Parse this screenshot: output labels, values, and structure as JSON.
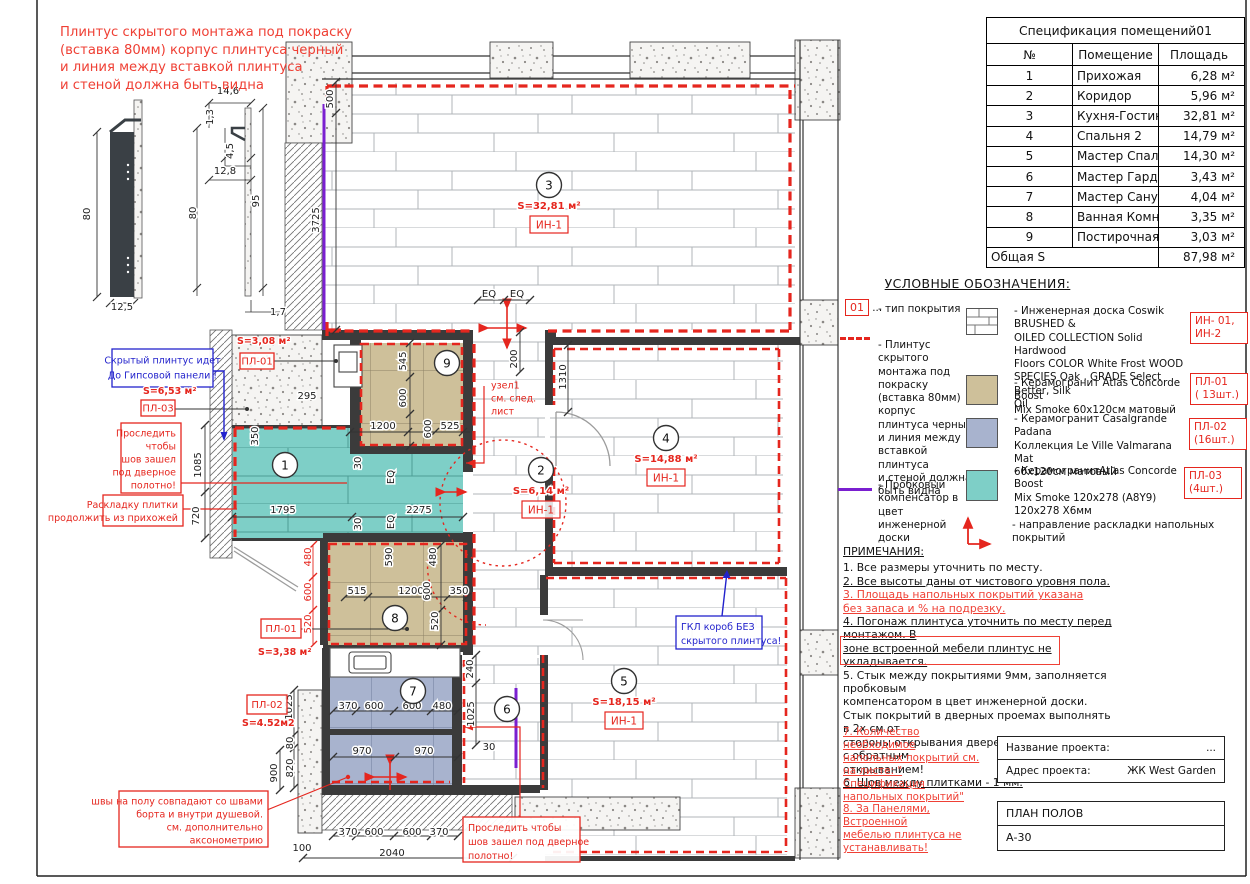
{
  "colors": {
    "red": "#e5261e",
    "notered": "#ef4035",
    "blue": "#2323cc",
    "purple": "#7a1fd0",
    "teal": "#7ecfc7",
    "tan": "#cec09a",
    "bluegray": "#a8b3ce",
    "wall": "#3b3b3b",
    "ink": "#1c1c1c"
  },
  "top_note": {
    "lines": [
      "Плинтус скрытого монтажа под покраску",
      "(вставка 80мм) корпус плинтуса черный",
      "и линия между вставкой плинтуса",
      "и стеной должна быть видна"
    ]
  },
  "spec_table": {
    "title": "Спецификация помещений01",
    "headers": {
      "n": "№",
      "name": "Помещение",
      "area": "Площадь"
    },
    "rows": [
      {
        "n": "1",
        "name": "Прихожая",
        "area": "6,28 м²"
      },
      {
        "n": "2",
        "name": "Коридор",
        "area": "5,96 м²"
      },
      {
        "n": "3",
        "name": "Кухня-Гостиная",
        "area": "32,81 м²"
      },
      {
        "n": "4",
        "name": "Спальня 2",
        "area": "14,79 м²"
      },
      {
        "n": "5",
        "name": "Мастер Спальня",
        "area": "14,30 м²"
      },
      {
        "n": "6",
        "name": "Мастер Гардеробная",
        "area": "3,43 м²"
      },
      {
        "n": "7",
        "name": "Мастер Санузел",
        "area": "4,04 м²"
      },
      {
        "n": "8",
        "name": "Ванная Комната",
        "area": "3,35 м²"
      },
      {
        "n": "9",
        "name": "Постирочная/Гардеробная",
        "area": "3,03 м²"
      }
    ],
    "total": {
      "label": "Общая S",
      "value": "87,98 м²"
    }
  },
  "legend": {
    "title": "УСЛОВНЫЕ ОБОЗНАЧЕНИЯ:",
    "type_code": "01",
    "type_dots": "...",
    "type_text": "- тип покрытия",
    "plinth_lines": [
      "- Плинтус скрытого",
      "монтажа под",
      "покраску",
      "(вставка 80мм)",
      "корпус",
      "плинтуса черный",
      "и линия между",
      "вставкой плинтуса",
      "и стеной должна",
      "быть видна"
    ],
    "cork_lines": [
      "- Пробковый",
      "компенсатор в цвет",
      "инженерной доски"
    ],
    "wood_lines": [
      "- Инженерная доска Coswik BRUSHED &",
      "OILED COLLECTION Solid Hardwood",
      "Floors COLOR White Frost WOOD",
      "SPECIES  Oak , GRADE Select  Better,  Silk",
      "Oil"
    ],
    "wood_tag": [
      "ИН- 01,",
      "ИН-2"
    ],
    "tile1_lines": [
      "- Керамогранит Atlas Concorde Boost",
      "Mix Smoke  60x120см матовый"
    ],
    "tile1_tag": [
      "ПЛ-01",
      "( 13шт.)"
    ],
    "tile2_lines": [
      "- Керамогранит Casalgrande Padana",
      "Коллекция Le Ville Valmarana Mat",
      "60x120см матовый"
    ],
    "tile2_tag": [
      "ПЛ-02",
      "(16шт.)"
    ],
    "tile3_lines": [
      "- КерамогранитAtlas Concorde  Boost",
      "Mix Smoke 120x278 (A8Y9)",
      "120x278 Х6мм"
    ],
    "tile3_tag": [
      "ПЛ-03",
      "(4шт.)"
    ],
    "direction_text": "- направление раскладки  напольных покрытий"
  },
  "notes": {
    "title": "ПРИМЕЧАНИЯ:",
    "n1": "1. Все размеры уточнить по месту.",
    "n2": "2. Все высоты даны от чистового уровня пола.",
    "n3a": "3. Площадь напольных покрытий указана",
    "n3b": "без запаса и % на подрезку.",
    "n4a": "4. Погонаж плинтуса уточнить по месту перед монтажом. В",
    "n4b": "зоне встроенной мебели плинтус не укладывается.",
    "n5a": "5. Стык между покрытиями 9мм,  заполняется пробковым",
    "n5b": "компенсатором в цвет инженерной доски.",
    "n5c": "Стык покрытий в дверных проемах выполнять в 2х см от",
    "n5d": "стороны открывания дверей. Учитывать двери с обратным",
    "n5e": "открыванием!",
    "n6": "6. Шов между плитками - 1 мм.",
    "n7a": "7. Количество необходимое",
    "n7b": "напольных покрытий см.",
    "n7c": "на листе: \" Спецификация",
    "n7d": "напольных покрытий\"",
    "n8a": "8. За Панелями, Встроенной",
    "n8b": "мебелью плинтуса  не",
    "n8c": "устанавливать!"
  },
  "title_block": {
    "name_label": "Название проекта:",
    "name_value": "...",
    "addr_label": "Адрес проекта:",
    "addr_value": "ЖК West Garden",
    "sheet_name": "ПЛАН ПОЛОВ",
    "sheet_code": "А-30"
  },
  "plan": {
    "dims": [
      {
        "t": "80",
        "x": 90,
        "y": 214,
        "r": 1
      },
      {
        "t": "12,5",
        "x": 122,
        "y": 310
      },
      {
        "t": "14,6",
        "x": 228,
        "y": 94
      },
      {
        "t": "1,3",
        "x": 213,
        "y": 117,
        "r": 1
      },
      {
        "t": "4,5",
        "x": 233,
        "y": 151,
        "r": 1
      },
      {
        "t": "12,8",
        "x": 225,
        "y": 174
      },
      {
        "t": "80",
        "x": 196,
        "y": 213,
        "r": 1
      },
      {
        "t": "95",
        "x": 259,
        "y": 201,
        "r": 1
      },
      {
        "t": "1,7",
        "x": 278,
        "y": 315
      },
      {
        "t": "500",
        "x": 333,
        "y": 99,
        "r": 1
      },
      {
        "t": "3725",
        "x": 319,
        "y": 220,
        "r": 1
      },
      {
        "t": "EQ",
        "x": 489,
        "y": 297
      },
      {
        "t": "EQ",
        "x": 517,
        "y": 297
      },
      {
        "t": "200",
        "x": 517,
        "y": 359,
        "r": 1
      },
      {
        "t": "1310",
        "x": 566,
        "y": 377,
        "r": 1
      },
      {
        "t": "545",
        "x": 406,
        "y": 361,
        "r": 1
      },
      {
        "t": "600",
        "x": 406,
        "y": 398,
        "r": 1
      },
      {
        "t": "1200",
        "x": 383,
        "y": 429
      },
      {
        "t": "600",
        "x": 431,
        "y": 429,
        "r": 1
      },
      {
        "t": "525",
        "x": 450,
        "y": 429
      },
      {
        "t": "295",
        "x": 307,
        "y": 399
      },
      {
        "t": "350",
        "x": 258,
        "y": 436,
        "r": 1
      },
      {
        "t": "1085",
        "x": 201,
        "y": 465,
        "r": 1
      },
      {
        "t": "720",
        "x": 199,
        "y": 516,
        "r": 1
      },
      {
        "t": "30",
        "x": 361,
        "y": 463,
        "r": 1
      },
      {
        "t": "EQ",
        "x": 394,
        "y": 477,
        "r": 1
      },
      {
        "t": "EQ",
        "x": 394,
        "y": 522,
        "r": 1
      },
      {
        "t": "30",
        "x": 361,
        "y": 524,
        "r": 1
      },
      {
        "t": "1795",
        "x": 283,
        "y": 513
      },
      {
        "t": "2275",
        "x": 419,
        "y": 513
      },
      {
        "t": "480",
        "x": 311,
        "y": 557,
        "r": 1,
        "c": 1
      },
      {
        "t": "600",
        "x": 311,
        "y": 592,
        "r": 1,
        "c": 1
      },
      {
        "t": "520",
        "x": 311,
        "y": 624,
        "r": 1,
        "c": 1
      },
      {
        "t": "590",
        "x": 392,
        "y": 557,
        "r": 1
      },
      {
        "t": "480",
        "x": 436,
        "y": 557,
        "r": 1
      },
      {
        "t": "515",
        "x": 357,
        "y": 594
      },
      {
        "t": "1200",
        "x": 411,
        "y": 594
      },
      {
        "t": "600",
        "x": 430,
        "y": 591,
        "r": 1
      },
      {
        "t": "350",
        "x": 459,
        "y": 594
      },
      {
        "t": "520",
        "x": 438,
        "y": 621,
        "r": 1
      },
      {
        "t": "240",
        "x": 473,
        "y": 669,
        "r": 1
      },
      {
        "t": "1025",
        "x": 292,
        "y": 707,
        "r": 1
      },
      {
        "t": "370",
        "x": 348,
        "y": 709
      },
      {
        "t": "600",
        "x": 374,
        "y": 709
      },
      {
        "t": "600",
        "x": 412,
        "y": 709
      },
      {
        "t": "480",
        "x": 442,
        "y": 709
      },
      {
        "t": "1025",
        "x": 474,
        "y": 714,
        "r": 1
      },
      {
        "t": "970",
        "x": 362,
        "y": 754
      },
      {
        "t": "970",
        "x": 424,
        "y": 754
      },
      {
        "t": "30",
        "x": 489,
        "y": 750
      },
      {
        "t": "80",
        "x": 293,
        "y": 743,
        "r": 1
      },
      {
        "t": "820",
        "x": 293,
        "y": 768,
        "r": 1
      },
      {
        "t": "900",
        "x": 277,
        "y": 773,
        "r": 1
      },
      {
        "t": "370",
        "x": 348,
        "y": 835
      },
      {
        "t": "600",
        "x": 374,
        "y": 835
      },
      {
        "t": "600",
        "x": 412,
        "y": 835
      },
      {
        "t": "370",
        "x": 439,
        "y": 835
      },
      {
        "t": "100",
        "x": 302,
        "y": 851
      },
      {
        "t": "2040",
        "x": 392,
        "y": 856
      }
    ],
    "rooms": [
      {
        "n": "1",
        "x": 285,
        "y": 465
      },
      {
        "n": "2",
        "x": 541,
        "y": 470,
        "area": "S=6,14 м²",
        "coat": "ИН-1"
      },
      {
        "n": "3",
        "x": 549,
        "y": 185,
        "area": "S=32,81 м²",
        "coat": "ИН-1"
      },
      {
        "n": "4",
        "x": 666,
        "y": 438,
        "area": "S=14,88 м²",
        "coat": "ИН-1"
      },
      {
        "n": "5",
        "x": 624,
        "y": 681,
        "area": "S=18,15 м²",
        "coat": "ИН-1"
      },
      {
        "n": "6",
        "x": 507,
        "y": 709
      },
      {
        "n": "7",
        "x": 413,
        "y": 691
      },
      {
        "n": "8",
        "x": 395,
        "y": 618
      },
      {
        "n": "9",
        "x": 447,
        "y": 363
      }
    ],
    "labels": [
      {
        "t": "S=3,08 м²",
        "x": 237,
        "y": 344
      },
      {
        "t": "S=6,53 м²",
        "x": 143,
        "y": 394
      },
      {
        "t": "S=3,38 м²",
        "x": 258,
        "y": 655
      },
      {
        "t": "S=4.52м2",
        "x": 242,
        "y": 726
      }
    ],
    "boxes": [
      {
        "t": "ПЛ-01",
        "x": 240,
        "y": 353,
        "w": 34,
        "h": 16
      },
      {
        "t": "ПЛ-03",
        "x": 141,
        "y": 400,
        "w": 34,
        "h": 16
      },
      {
        "t": "ПЛ-01",
        "x": 261,
        "y": 619,
        "w": 40,
        "h": 19
      },
      {
        "t": "ПЛ-02",
        "x": 247,
        "y": 695,
        "w": 40,
        "h": 19
      }
    ],
    "callouts": {
      "hidden_plinth": {
        "x": 112,
        "y": 349,
        "w": 101,
        "h": 38,
        "color": "blue",
        "align": "center",
        "lh": 15,
        "fs": 10.5,
        "lines": [
          "Скрытый плинтус идет",
          "До Гипсовой панели !"
        ]
      },
      "follow1": {
        "x": 121,
        "y": 423,
        "w": 60,
        "h": 70,
        "color": "red",
        "align": "right",
        "lh": 13,
        "fs": 9.5,
        "lines": [
          "Проследить",
          "чтобы",
          "шов зашел",
          "под дверное",
          "полотно!"
        ]
      },
      "layout": {
        "x": 103,
        "y": 495,
        "w": 80,
        "h": 31,
        "color": "red",
        "align": "right",
        "lh": 13,
        "fs": 9,
        "lines": [
          "Раскладку плитки",
          "продолжить из прихожей"
        ]
      },
      "seams": {
        "x": 119,
        "y": 791,
        "w": 149,
        "h": 56,
        "color": "red",
        "align": "right",
        "lh": 13,
        "fs": 9.5,
        "lines": [
          "швы на полу совпадают со швами",
          "борта и внутри душевой.",
          "см. дополнительно",
          "аксонометрию"
        ]
      },
      "follow2": {
        "x": 463,
        "y": 817,
        "w": 117,
        "h": 45,
        "color": "red",
        "align": "left",
        "lh": 14,
        "fs": 10,
        "lines": [
          "Проследить  чтобы",
          "шов зашел под дверное",
          "полотно!"
        ]
      },
      "gkl": {
        "x": 676,
        "y": 616,
        "w": 86,
        "h": 33,
        "color": "blue",
        "align": "left",
        "lh": 14,
        "fs": 10,
        "lines": [
          "ГКЛ короб БЕЗ",
          "скрытого плинтуса!"
        ]
      },
      "uzel": {
        "x": 486,
        "y": 375,
        "w": 60,
        "h": 42,
        "color": "red",
        "align": "left",
        "lh": 13,
        "fs": 9.5,
        "border": false,
        "lines": [
          "узел1",
          "см. след.",
          "лист"
        ]
      }
    }
  }
}
